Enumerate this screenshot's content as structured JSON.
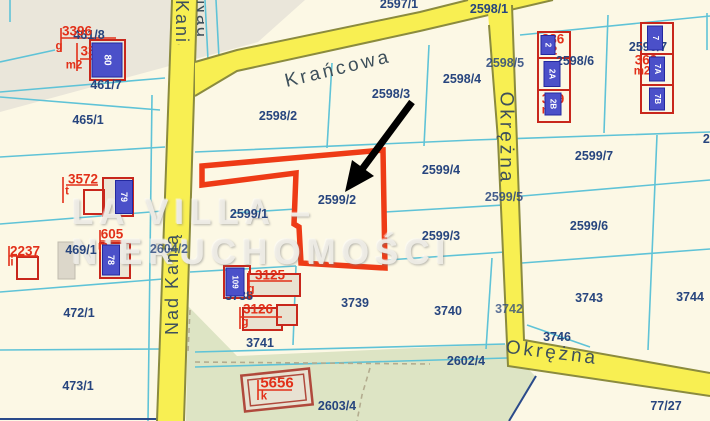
{
  "watermark": "LA VILLA – NIERUCHOMOŚCI",
  "highlight": {
    "parcel": "2599/2",
    "outline_color": "#ee3b16"
  },
  "streets": {
    "krancowa": "Krańcowa",
    "nad_kania": "Nad Kanią",
    "okrezna": "Okrężna"
  },
  "colors": {
    "background": "#fcf8e5",
    "green_area": "#dde4c4",
    "gray_area": "#eae6da",
    "parcel_line": "#5fc3d7",
    "navy_text": "#27457e",
    "red_text": "#e23019",
    "street_fill": "#f8ef52",
    "street_border": "#8b8b3e",
    "building_outline": "#c8271c",
    "building_plate": "#4b50c9"
  },
  "labels": [
    {
      "text": "Krańcowa",
      "x": 338,
      "y": 69,
      "cls": "street",
      "rot": -13.5,
      "name": "street-label-krancowa"
    },
    {
      "text": "Nad Kanią",
      "x": 172,
      "y": 284,
      "cls": "street-sm",
      "rot": -90,
      "name": "street-label-nad-kania"
    },
    {
      "text": "Okrężna",
      "x": 506,
      "y": 138,
      "cls": "street",
      "rot": 90,
      "name": "street-label-okrezna-vertical"
    },
    {
      "text": "Okrężna",
      "x": 552,
      "y": 353,
      "cls": "street",
      "rot": 7,
      "name": "street-label-okrezna-horizontal"
    },
    {
      "text": "2597/1",
      "x": 399,
      "y": 4,
      "cls": "lbl-navy"
    },
    {
      "text": "461/8",
      "x": 89,
      "y": 35,
      "cls": "lbl-navy"
    },
    {
      "text": "461/7",
      "x": 106,
      "y": 85,
      "cls": "lbl-navy"
    },
    {
      "text": "465/1",
      "x": 88,
      "y": 120,
      "cls": "lbl-navy"
    },
    {
      "text": "469/1",
      "x": 81,
      "y": 250,
      "cls": "lbl-navy"
    },
    {
      "text": "472/1",
      "x": 79,
      "y": 313,
      "cls": "lbl-navy"
    },
    {
      "text": "473/1",
      "x": 78,
      "y": 386,
      "cls": "lbl-navy"
    },
    {
      "text": "2604/2",
      "x": 169,
      "y": 249,
      "cls": "lbl-navy",
      "op": 0.8
    },
    {
      "text": "2598/2",
      "x": 278,
      "y": 116,
      "cls": "lbl-navy"
    },
    {
      "text": "2598/3",
      "x": 391,
      "y": 94,
      "cls": "lbl-navy"
    },
    {
      "text": "2598/4",
      "x": 462,
      "y": 79,
      "cls": "lbl-navy"
    },
    {
      "text": "2598/1",
      "x": 489,
      "y": 9,
      "cls": "lbl-navy"
    },
    {
      "text": "2598/5",
      "x": 505,
      "y": 63,
      "cls": "lbl-navy",
      "op": 0.85
    },
    {
      "text": "2598/6",
      "x": 575,
      "y": 61,
      "cls": "lbl-navy"
    },
    {
      "text": "2598/7",
      "x": 648,
      "y": 47,
      "cls": "lbl-navy"
    },
    {
      "text": "2599/4",
      "x": 441,
      "y": 170,
      "cls": "lbl-navy"
    },
    {
      "text": "2599/3",
      "x": 441,
      "y": 236,
      "cls": "lbl-navy"
    },
    {
      "text": "2599/2",
      "x": 337,
      "y": 200,
      "cls": "lbl-navy"
    },
    {
      "text": "2599/1",
      "x": 249,
      "y": 214,
      "cls": "lbl-navy"
    },
    {
      "text": "2599/7",
      "x": 594,
      "y": 156,
      "cls": "lbl-navy"
    },
    {
      "text": "2599/5",
      "x": 504,
      "y": 197,
      "cls": "lbl-navy",
      "op": 0.85
    },
    {
      "text": "2599/6",
      "x": 589,
      "y": 226,
      "cls": "lbl-navy"
    },
    {
      "text": "2599/8",
      "x": 722,
      "y": 139,
      "cls": "lbl-navy"
    },
    {
      "text": "3738",
      "x": 239,
      "y": 296,
      "cls": "lbl-navy"
    },
    {
      "text": "3739",
      "x": 355,
      "y": 303,
      "cls": "lbl-navy"
    },
    {
      "text": "3740",
      "x": 448,
      "y": 311,
      "cls": "lbl-navy"
    },
    {
      "text": "3741",
      "x": 260,
      "y": 343,
      "cls": "lbl-navy"
    },
    {
      "text": "2602/4",
      "x": 466,
      "y": 361,
      "cls": "lbl-navy"
    },
    {
      "text": "2603/4",
      "x": 337,
      "y": 406,
      "cls": "lbl-navy"
    },
    {
      "text": "3742",
      "x": 509,
      "y": 309,
      "cls": "lbl-navy",
      "op": 0.75
    },
    {
      "text": "3743",
      "x": 589,
      "y": 298,
      "cls": "lbl-navy"
    },
    {
      "text": "3744",
      "x": 690,
      "y": 297,
      "cls": "lbl-navy"
    },
    {
      "text": "3746",
      "x": 557,
      "y": 337,
      "cls": "lbl-navy"
    },
    {
      "text": "77/27",
      "x": 666,
      "y": 406,
      "cls": "lbl-navy"
    },
    {
      "text": "3396",
      "x": 77,
      "y": 31,
      "cls": "lbl-red"
    },
    {
      "text": "g",
      "x": 59,
      "y": 47,
      "cls": "lbl-red-sm"
    },
    {
      "text": "33",
      "x": 88,
      "y": 51,
      "cls": "lbl-red"
    },
    {
      "text": "m2",
      "x": 74,
      "y": 66,
      "cls": "lbl-red-sm"
    },
    {
      "text": "3572",
      "x": 83,
      "y": 179,
      "cls": "lbl-red"
    },
    {
      "text": "t",
      "x": 67,
      "y": 192,
      "cls": "lbl-red-sm"
    },
    {
      "text": "605",
      "x": 112,
      "y": 234,
      "cls": "lbl-red"
    },
    {
      "text": "m",
      "x": 103,
      "y": 247,
      "cls": "lbl-red-sm"
    },
    {
      "text": "2237",
      "x": 25,
      "y": 251,
      "cls": "lbl-red"
    },
    {
      "text": "i",
      "x": 12,
      "y": 263,
      "cls": "lbl-red-sm"
    },
    {
      "text": "3125",
      "x": 270,
      "y": 275,
      "cls": "lbl-red"
    },
    {
      "text": "g",
      "x": 251,
      "y": 290,
      "cls": "lbl-red-sm"
    },
    {
      "text": "3126",
      "x": 258,
      "y": 309,
      "cls": "lbl-red"
    },
    {
      "text": "g",
      "x": 245,
      "y": 323,
      "cls": "lbl-red-sm"
    },
    {
      "text": "5656",
      "x": 277,
      "y": 383,
      "cls": "lbl-red-lg"
    },
    {
      "text": "k",
      "x": 264,
      "y": 397,
      "cls": "lbl-red-sm"
    },
    {
      "text": "386",
      "x": 553,
      "y": 39,
      "cls": "lbl-red"
    },
    {
      "text": "m2",
      "x": 549,
      "y": 52,
      "cls": "lbl-red-sm"
    },
    {
      "text": "389",
      "x": 553,
      "y": 99,
      "cls": "lbl-red"
    },
    {
      "text": "m2",
      "x": 550,
      "y": 111,
      "cls": "lbl-red-sm"
    },
    {
      "text": "369",
      "x": 646,
      "y": 60,
      "cls": "lbl-red"
    },
    {
      "text": "m2",
      "x": 642,
      "y": 72,
      "cls": "lbl-red-sm"
    },
    {
      "text": "80",
      "x": 107,
      "y": 60,
      "cls": "plate",
      "rot": 90,
      "w": 33,
      "h": 29,
      "fs": 10,
      "name": "building-plate"
    },
    {
      "text": "79",
      "x": 124,
      "y": 197,
      "cls": "plate",
      "rot": 90,
      "w": 32,
      "h": 16,
      "fs": 9,
      "name": "building-plate"
    },
    {
      "text": "78",
      "x": 111,
      "y": 260,
      "cls": "plate",
      "rot": 90,
      "w": 29,
      "h": 16,
      "fs": 9,
      "name": "building-plate"
    },
    {
      "text": "109",
      "x": 235,
      "y": 282,
      "cls": "plate",
      "rot": 90,
      "w": 27,
      "h": 17,
      "fs": 8,
      "name": "building-plate"
    },
    {
      "text": "2",
      "x": 548,
      "y": 45,
      "cls": "plate",
      "rot": 90,
      "w": 18,
      "h": 13,
      "fs": 8,
      "name": "building-plate"
    },
    {
      "text": "2A",
      "x": 552,
      "y": 74,
      "cls": "plate",
      "rot": 90,
      "w": 24,
      "h": 15,
      "fs": 8,
      "name": "building-plate"
    },
    {
      "text": "2B",
      "x": 553,
      "y": 104,
      "cls": "plate",
      "rot": 90,
      "w": 21,
      "h": 15,
      "fs": 8,
      "name": "building-plate"
    },
    {
      "text": "7",
      "x": 655,
      "y": 38,
      "cls": "plate",
      "rot": 90,
      "w": 23,
      "h": 14,
      "fs": 8,
      "name": "building-plate"
    },
    {
      "text": "7A",
      "x": 657,
      "y": 69,
      "cls": "plate",
      "rot": 90,
      "w": 23,
      "h": 14,
      "fs": 8,
      "name": "building-plate"
    },
    {
      "text": "7B",
      "x": 657,
      "y": 99,
      "cls": "plate",
      "rot": 90,
      "w": 21,
      "h": 14,
      "fs": 8,
      "name": "building-plate"
    }
  ]
}
